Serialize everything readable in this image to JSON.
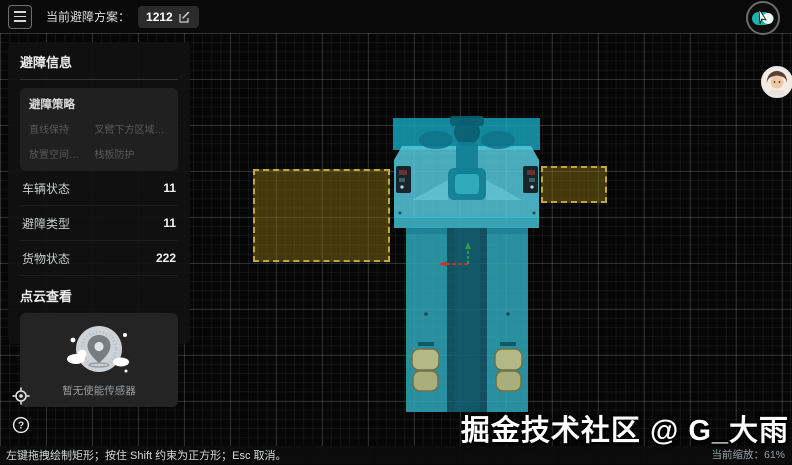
{
  "colors": {
    "background": "#060606",
    "vehicle_teal": "#35b6c9",
    "zone_yellow": "#bfa83e",
    "panel_dark": "#1a1a1a",
    "axis_red": "#c93030",
    "axis_green": "#2f9e3f"
  },
  "top_bar": {
    "label": "当前避障方案：",
    "plan_badge": "1212"
  },
  "sidebar": {
    "title": "避障信息",
    "strategy": {
      "title": "避障策略",
      "items": [
        "直线保持",
        "叉臂下方区域保...",
        "放置空间检测",
        "栈板防护"
      ]
    },
    "stats": [
      {
        "label": "车辆状态",
        "value": "11"
      },
      {
        "label": "避障类型",
        "value": "11"
      },
      {
        "label": "货物状态",
        "value": "222"
      }
    ],
    "pointcloud_title": "点云查看",
    "pointcloud_empty": "暂无使能传感器"
  },
  "canvas": {
    "vehicle": "forklift-agv-top-down",
    "zones": 2
  },
  "footer": {
    "hint": "左键拖拽绘制矩形；按住 Shift 约束为正方形；Esc 取消。",
    "zoom": "当前缩放：61%"
  },
  "watermark": "掘金技术社区 @ G_大雨"
}
